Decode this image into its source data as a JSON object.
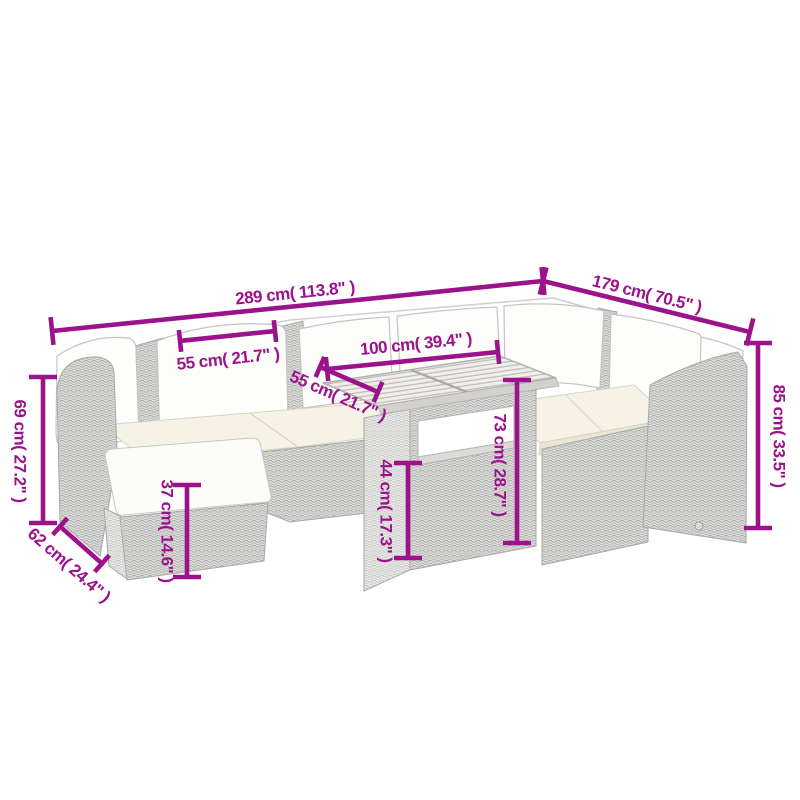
{
  "alt": "Dimension diagram of a grey poly rattan garden corner sofa set with white cushions, a footstool and a slatted-top table",
  "colors": {
    "dimension": "#9b128b",
    "background": "#ffffff",
    "sketch_line": "#a9a8a5",
    "seat_cushion": "#f6f2e6",
    "pillow": "#fdfdfc"
  },
  "dims": {
    "d289": {
      "label": "289 cm( 113.8\" )",
      "cm": "289",
      "in": "113.8"
    },
    "d179": {
      "label": "179 cm( 70.5\" )",
      "cm": "179",
      "in": "70.5"
    },
    "d85": {
      "label": "85 cm( 33.5\" )",
      "cm": "85",
      "in": "33.5"
    },
    "d69": {
      "label": "69 cm( 27.2\" )",
      "cm": "69",
      "in": "27.2"
    },
    "d62": {
      "label": "62 cm( 24.4\" )",
      "cm": "62",
      "in": "24.4"
    },
    "d55a": {
      "label": "55 cm( 21.7\" )",
      "cm": "55",
      "in": "21.7"
    },
    "d55b": {
      "label": "55 cm( 21.7\" )",
      "cm": "55",
      "in": "21.7"
    },
    "d100": {
      "label": "100 cm( 39.4\" )",
      "cm": "100",
      "in": "39.4"
    },
    "d73": {
      "label": "73 cm( 28.7\" )",
      "cm": "73",
      "in": "28.7"
    },
    "d44": {
      "label": "44 cm( 17.3\" )",
      "cm": "44",
      "in": "17.3"
    },
    "d37": {
      "label": "37 cm( 14.6\" )",
      "cm": "37",
      "in": "14.6"
    }
  }
}
